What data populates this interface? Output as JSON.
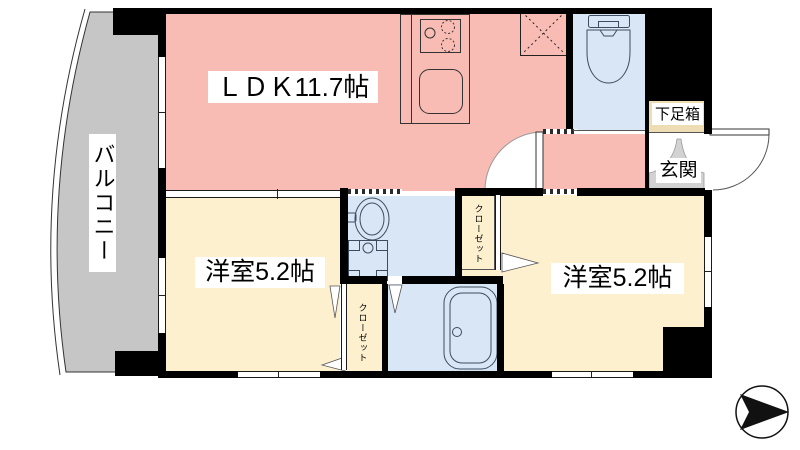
{
  "floorplan": {
    "type": "japanese-apartment-floor-plan",
    "rooms": {
      "ldk": {
        "label": "ＬＤＫ11.7帖"
      },
      "bedroom_left": {
        "label": "洋室5.2帖"
      },
      "bedroom_right": {
        "label": "洋室5.2帖"
      },
      "balcony": {
        "label": "バルコニー"
      },
      "entrance": {
        "label": "玄関"
      },
      "shoe_cabinet": {
        "label": "下足箱"
      },
      "closet_left": {
        "label": "クローゼット"
      },
      "closet_right": {
        "label": "クローゼット"
      }
    },
    "colors": {
      "ldk_pink": "#f9bcb4",
      "room_cream": "#fcf0cf",
      "wet_area_blue": "#d9e6f5",
      "balcony_gray": "#c6c6c6",
      "entrance_gray": "#d2d2d2",
      "shoe_area_tan": "#eedcb2",
      "wall_black": "#000000"
    },
    "compass": {
      "symbol": "▶"
    }
  }
}
